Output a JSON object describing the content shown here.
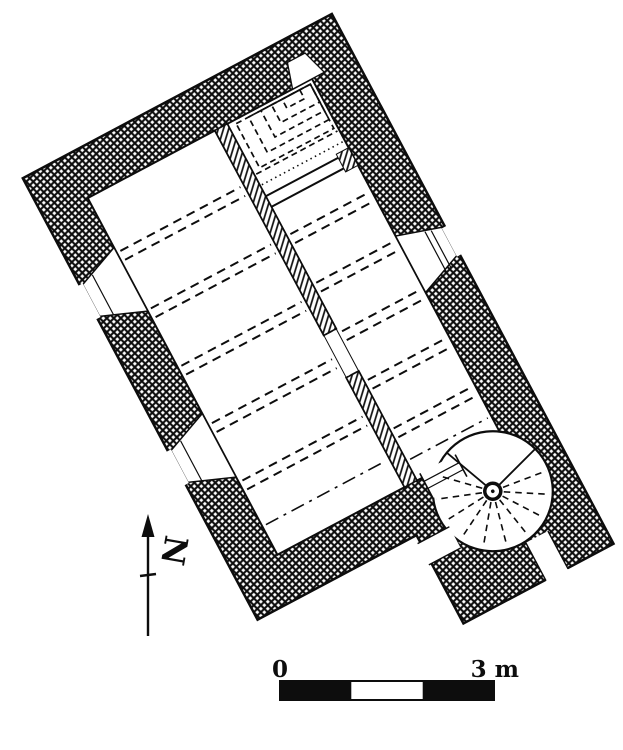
{
  "figure": {
    "kind": "architectural-floor-plan",
    "description": "ground plan of a two-room building with winder stair and spiral stair tower",
    "colors": {
      "ink": "#0d0d0d",
      "paper": "#ffffff"
    }
  },
  "north_arrow": {
    "label": "N"
  },
  "scale_bar": {
    "start": "0",
    "end": "3 m"
  }
}
